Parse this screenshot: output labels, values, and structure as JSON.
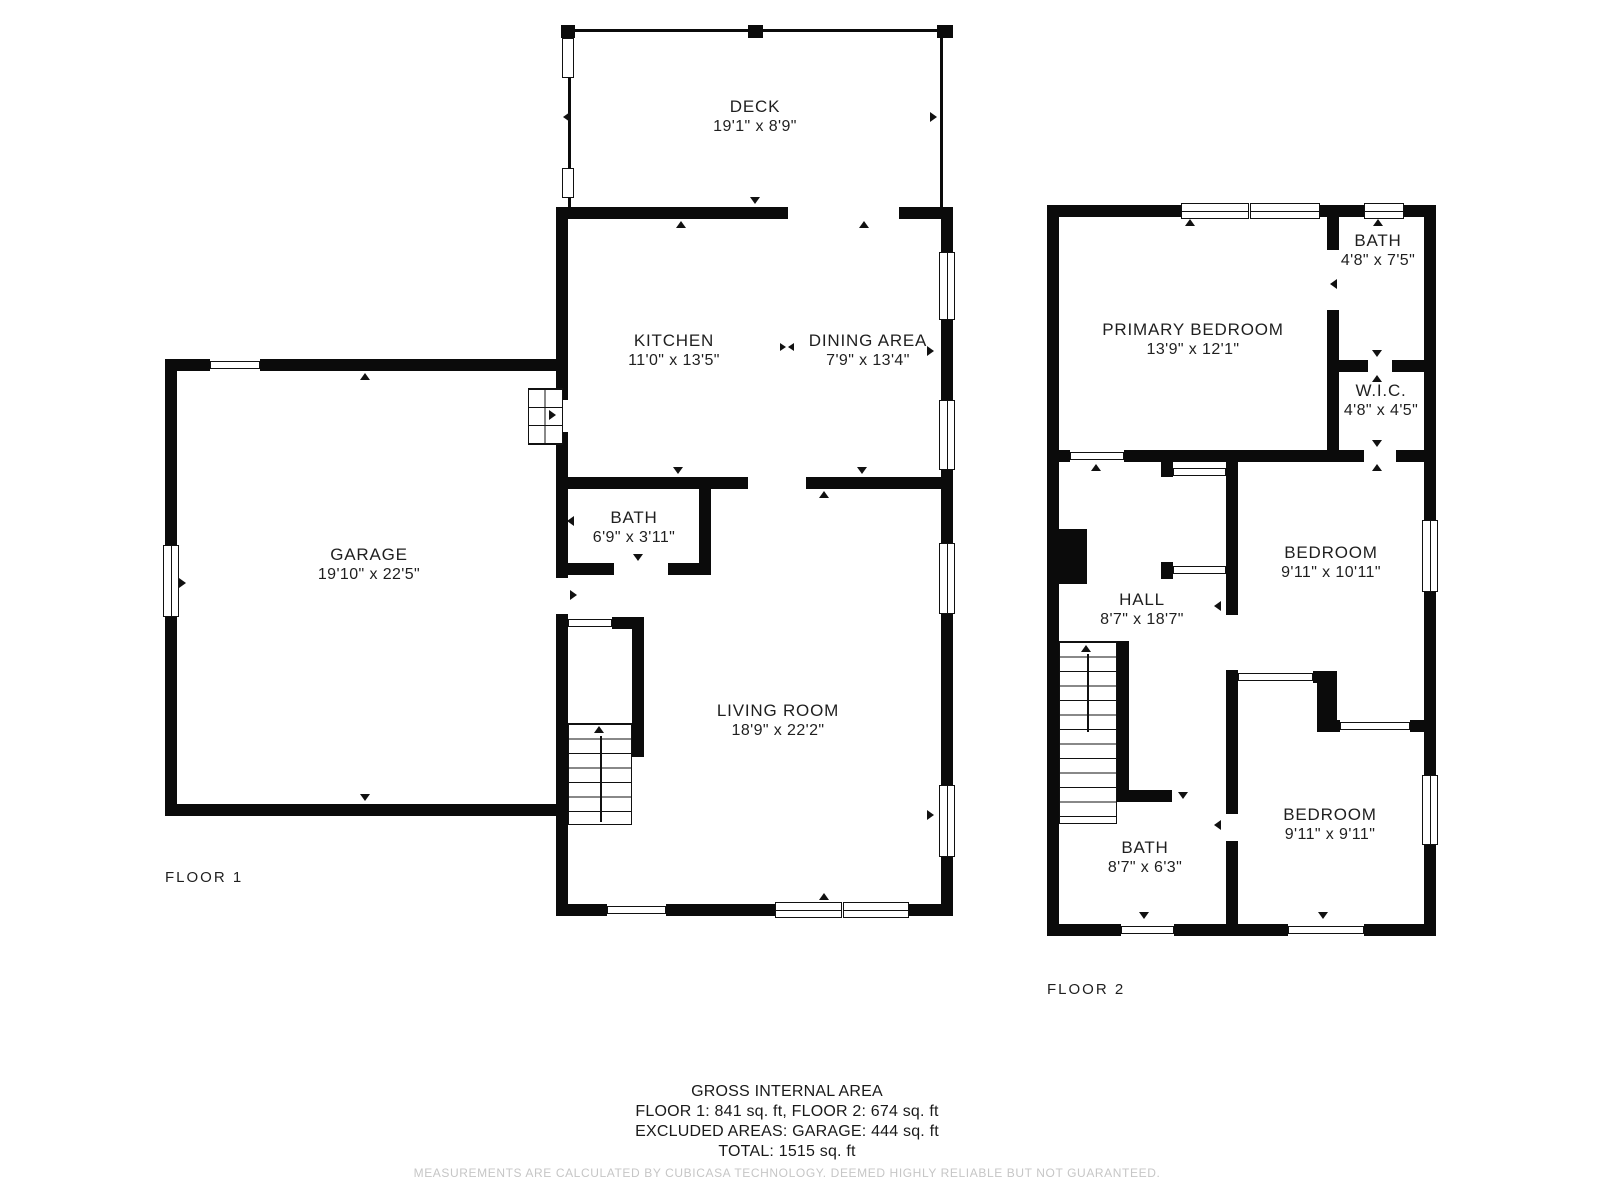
{
  "floor1": {
    "label": "FLOOR 1",
    "rooms": {
      "deck": {
        "name": "DECK",
        "dims": "19'1\" x 8'9\""
      },
      "kitchen": {
        "name": "KITCHEN",
        "dims": "11'0\" x 13'5\""
      },
      "dining": {
        "name": "DINING AREA",
        "dims": "7'9\" x 13'4\""
      },
      "garage": {
        "name": "GARAGE",
        "dims": "19'10\" x 22'5\""
      },
      "bath": {
        "name": "BATH",
        "dims": "6'9\" x 3'11\""
      },
      "living": {
        "name": "LIVING ROOM",
        "dims": "18'9\" x 22'2\""
      }
    }
  },
  "floor2": {
    "label": "FLOOR 2",
    "rooms": {
      "primary": {
        "name": "PRIMARY BEDROOM",
        "dims": "13'9\" x 12'1\""
      },
      "bath_top": {
        "name": "BATH",
        "dims": "4'8\" x 7'5\""
      },
      "wic": {
        "name": "W.I.C.",
        "dims": "4'8\" x 4'5\""
      },
      "hall": {
        "name": "HALL",
        "dims": "8'7\" x 18'7\""
      },
      "bedroom_mid": {
        "name": "BEDROOM",
        "dims": "9'11\" x 10'11\""
      },
      "bath_bottom": {
        "name": "BATH",
        "dims": "8'7\" x 6'3\""
      },
      "bedroom_bottom": {
        "name": "BEDROOM",
        "dims": "9'11\" x 9'11\""
      }
    }
  },
  "footer": {
    "title": "GROSS INTERNAL AREA",
    "line1": "FLOOR 1: 841 sq. ft, FLOOR 2: 674 sq. ft",
    "line2": "EXCLUDED AREAS: GARAGE: 444 sq. ft",
    "total": "TOTAL: 1515 sq. ft",
    "disclaimer": "MEASUREMENTS ARE CALCULATED BY CUBICASA TECHNOLOGY. DEEMED HIGHLY RELIABLE BUT NOT GUARANTEED."
  },
  "colors": {
    "wall": "#0b0b0b",
    "text": "#1f1f1f",
    "disclaimer": "#c6c6c6"
  }
}
